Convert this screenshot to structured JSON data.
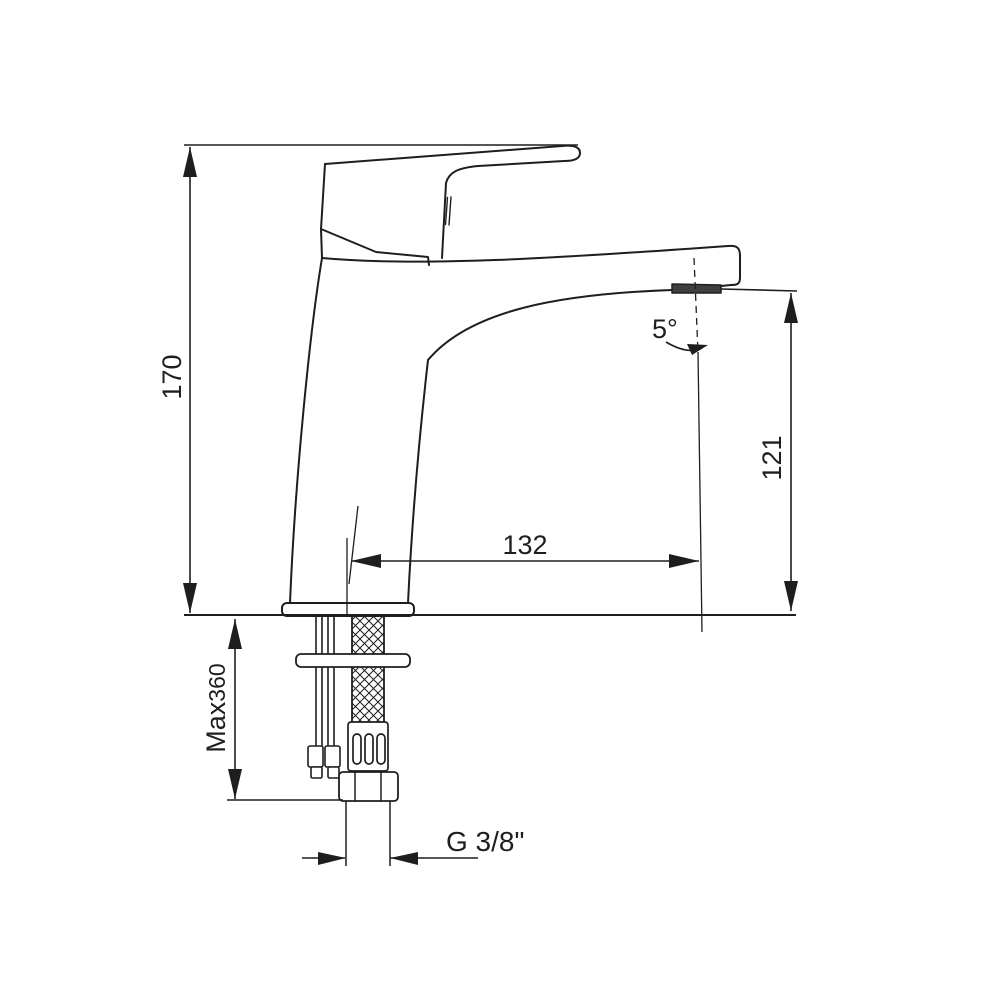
{
  "drawing": {
    "labels": {
      "total_height": "170",
      "spout_outlet_height": "121",
      "spout_reach": "132",
      "aerator_angle": "5°",
      "max_hose_prefix": "Max",
      "max_hose_value": "360",
      "connection_thread": "G 3/8\""
    },
    "colors": {
      "line": "#1e1e1e",
      "background": "#ffffff",
      "aerator_fill": "#3f3f3f"
    }
  }
}
